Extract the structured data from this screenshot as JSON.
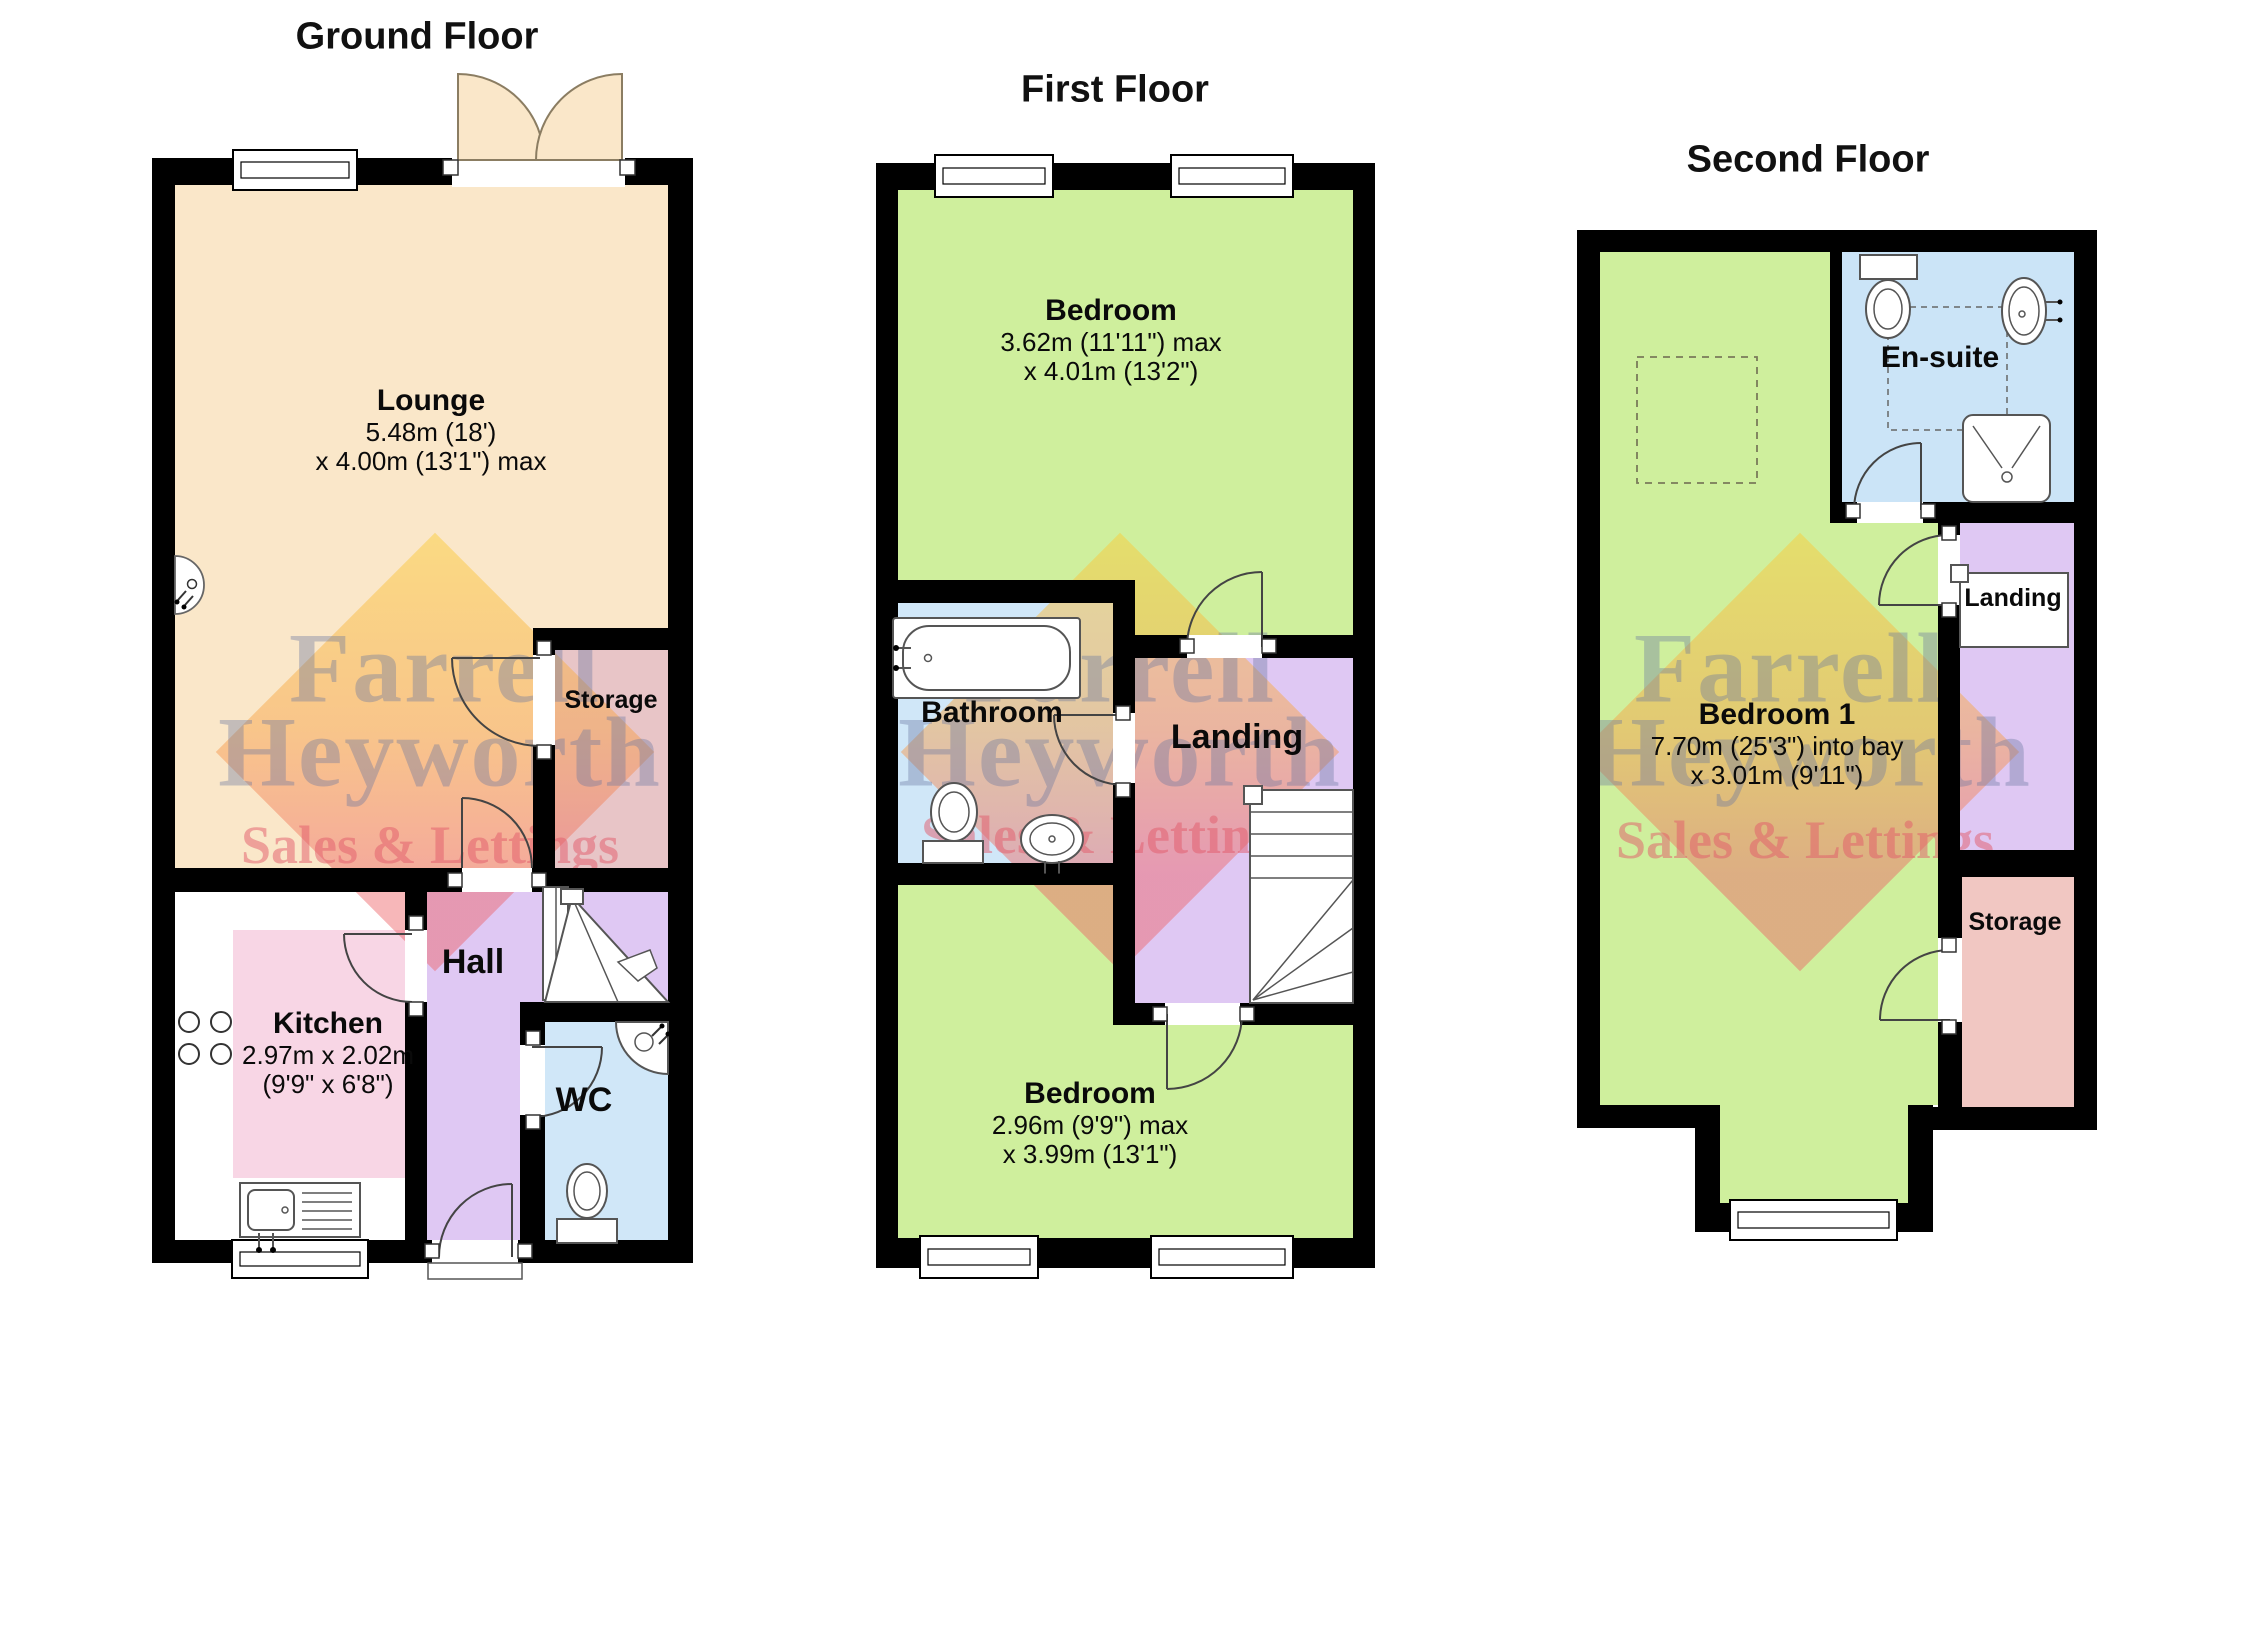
{
  "floors": [
    {
      "title": "Ground Floor",
      "rooms": [
        {
          "name": "Lounge",
          "dims": [
            "5.48m (18')",
            "x 4.00m (13'1\") max"
          ]
        },
        {
          "name": "Storage",
          "dims": []
        },
        {
          "name": "Kitchen",
          "dims": [
            "2.97m x 2.02m",
            "(9'9\" x 6'8\")"
          ]
        },
        {
          "name": "Hall",
          "dims": []
        },
        {
          "name": "WC",
          "dims": []
        }
      ]
    },
    {
      "title": "First Floor",
      "rooms": [
        {
          "name": "Bedroom",
          "dims": [
            "3.62m (11'11\") max",
            "x 4.01m (13'2\")"
          ]
        },
        {
          "name": "Bathroom",
          "dims": []
        },
        {
          "name": "Landing",
          "dims": []
        },
        {
          "name": "Bedroom",
          "dims": [
            "2.96m (9'9\") max",
            "x 3.99m (13'1\")"
          ]
        }
      ]
    },
    {
      "title": "Second Floor",
      "rooms": [
        {
          "name": "Bedroom 1",
          "dims": [
            "7.70m (25'3\") into bay",
            "x 3.01m (9'11\")"
          ]
        },
        {
          "name": "En-suite",
          "dims": []
        },
        {
          "name": "Landing",
          "dims": []
        },
        {
          "name": "Storage",
          "dims": []
        }
      ]
    }
  ],
  "watermark": {
    "brand_line1": "Farrell",
    "brand_line2": "Heyworth",
    "tagline": "Sales & Lettings"
  },
  "palette": {
    "wall": "#000000",
    "lounge": "#FAE7C9",
    "kitchen": "#F8D6E5",
    "hall_landing": "#DFC8F3",
    "wc_bathroom": "#D0E7F8",
    "ensuite": "#CBE4F7",
    "bedroom": "#CFEF9D",
    "storage_ground": "#E8C5C7",
    "storage_second": "#F1C7C2",
    "watermark_text": "#6876A0",
    "watermark_tagline": "#E15A69",
    "watermark_diamond_top": "#FACD3C",
    "watermark_diamond_bottom": "#ED5F64"
  },
  "icons": [
    "window",
    "french-doors",
    "door-swing",
    "stairs",
    "hob",
    "sink-drainer",
    "wall-light",
    "toilet",
    "corner-basin",
    "bath",
    "basin",
    "shower-tray",
    "dashed-square",
    "plumbing-dashes"
  ]
}
